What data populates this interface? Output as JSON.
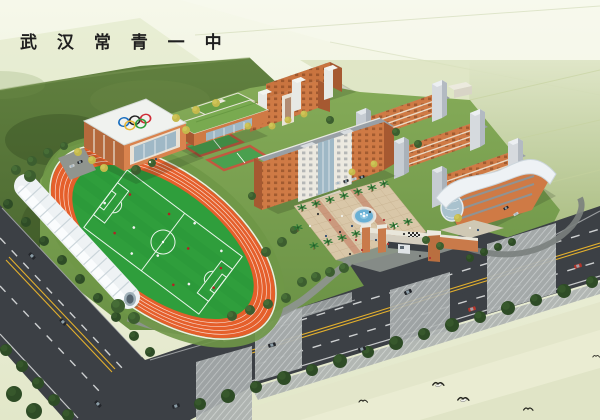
{
  "header": {
    "title": "武 汉 常 青 一 中"
  },
  "landmarks": [
    "gymnasium",
    "olympic-rings",
    "running-track",
    "soccer-field",
    "grandstand-canopy",
    "basketball-courts",
    "science-building",
    "dormitory-building",
    "main-classroom-building",
    "teaching-buildings",
    "library-curved-roof-building",
    "central-plaza",
    "fountain",
    "palm-trees",
    "entrance-gate",
    "gate-driveway",
    "main-road",
    "side-road",
    "intersection",
    "crosswalk-sidewalks",
    "roadside-trees",
    "cars",
    "pedestrians",
    "egrets"
  ],
  "colors": {
    "title_color": "#1f1f1f",
    "track": "#e55f2b",
    "pitch": "#2f9e3c",
    "road": "#3c4045",
    "road_yellow": "#e2af2d",
    "road_white": "#e8eaea",
    "sidewalk": "#a9aeae",
    "sidewalk_line": "#cfd3d3",
    "stand_white": "#eef2f4",
    "stand_rib": "#c7d2d8",
    "wall_orange": "#cf7a45",
    "wall_orange_dark": "#a65931",
    "wall_white": "#ece9e0",
    "tower_gray": "#c6ccd2",
    "roof_gray": "#99a0a6",
    "roof_green": "#79aa50",
    "glass": "#9fb8c6",
    "plaza": "#d9c7a8",
    "plaza_line": "#c3ad8b",
    "plaza_red": "#bd6c52",
    "water": "#69b0d4",
    "grass": "#7aa050",
    "forest": "#56743c",
    "tree_dark": "#2e4c26",
    "tree_mid": "#3c5e2f",
    "tree_yellow": "#c4b94c",
    "palm": "#2f7a36",
    "car_dark": "#23262b",
    "car_red": "#b5342a",
    "car_gray": "#c9ccce",
    "ring_blue": "#1a6fc0",
    "ring_black": "#222222",
    "ring_red": "#cf2b36",
    "ring_yellow": "#e8b93a",
    "ring_green": "#2f9e3c"
  },
  "scene": {
    "trees": [
      {
        "c": "mid",
        "items": [
          [
            16,
            170,
            5
          ],
          [
            32,
            161,
            5
          ],
          [
            48,
            153,
            5
          ],
          [
            64,
            146,
            4
          ]
        ]
      },
      {
        "c": "dark",
        "items": [
          [
            8,
            204,
            5
          ],
          [
            26,
            222,
            5
          ],
          [
            44,
            241,
            5
          ],
          [
            62,
            260,
            5
          ],
          [
            80,
            279,
            5
          ],
          [
            98,
            298,
            5
          ],
          [
            116,
            317,
            5
          ],
          [
            134,
            336,
            5
          ],
          [
            150,
            352,
            5
          ]
        ]
      },
      {
        "c": "dark",
        "items": [
          [
            6,
            350,
            6
          ],
          [
            22,
            366,
            6
          ],
          [
            38,
            383,
            6
          ],
          [
            54,
            400,
            6
          ],
          [
            14,
            394,
            8
          ],
          [
            34,
            411,
            8
          ],
          [
            68,
            415,
            6
          ]
        ]
      },
      {
        "c": "dark",
        "items": [
          [
            200,
            404,
            6
          ],
          [
            228,
            396,
            7
          ],
          [
            256,
            387,
            6
          ],
          [
            284,
            378,
            7
          ],
          [
            312,
            370,
            6
          ],
          [
            340,
            361,
            7
          ],
          [
            368,
            352,
            6
          ],
          [
            396,
            343,
            7
          ],
          [
            424,
            334,
            6
          ],
          [
            452,
            325,
            7
          ],
          [
            480,
            317,
            6
          ],
          [
            508,
            308,
            7
          ],
          [
            536,
            300,
            6
          ],
          [
            564,
            291,
            7
          ],
          [
            592,
            282,
            6
          ]
        ]
      },
      {
        "c": "mid",
        "items": [
          [
            232,
            316,
            5
          ],
          [
            250,
            310,
            5
          ],
          [
            268,
            304,
            5
          ],
          [
            286,
            298,
            5
          ],
          [
            302,
            282,
            5
          ],
          [
            316,
            277,
            5
          ],
          [
            330,
            272,
            5
          ],
          [
            344,
            268,
            5
          ]
        ]
      },
      {
        "c": "dark",
        "items": [
          [
            470,
            258,
            4
          ],
          [
            484,
            252,
            4
          ],
          [
            498,
            247,
            4
          ],
          [
            512,
            242,
            4
          ]
        ]
      },
      {
        "c": "mid",
        "items": [
          [
            136,
            170,
            5
          ],
          [
            152,
            163,
            4
          ],
          [
            252,
            196,
            4
          ],
          [
            266,
            252,
            5
          ],
          [
            282,
            242,
            5
          ],
          [
            294,
            230,
            4
          ],
          [
            426,
            240,
            4
          ],
          [
            440,
            246,
            4
          ],
          [
            330,
            120,
            4
          ],
          [
            396,
            132,
            4
          ],
          [
            418,
            144,
            4
          ],
          [
            30,
            176,
            6
          ],
          [
            118,
            306,
            7
          ],
          [
            134,
            318,
            6
          ]
        ]
      },
      {
        "c": "yellow",
        "items": [
          [
            78,
            152,
            4
          ],
          [
            92,
            160,
            4
          ],
          [
            104,
            168,
            4
          ],
          [
            186,
            130,
            4
          ],
          [
            176,
            118,
            4
          ],
          [
            196,
            110,
            4
          ],
          [
            216,
            103,
            4
          ],
          [
            272,
            126,
            3.5
          ],
          [
            288,
            120,
            3.5
          ],
          [
            304,
            114,
            3.5
          ],
          [
            458,
            218,
            4
          ],
          [
            248,
            126,
            3.5
          ],
          [
            352,
            172,
            3.5
          ],
          [
            374,
            164,
            3.5
          ]
        ]
      }
    ],
    "palms": [
      [
        302,
        212
      ],
      [
        316,
        208
      ],
      [
        330,
        204
      ],
      [
        344,
        200
      ],
      [
        358,
        196
      ],
      [
        372,
        192
      ],
      [
        384,
        188
      ],
      [
        314,
        250
      ],
      [
        328,
        246
      ],
      [
        342,
        242
      ],
      [
        356,
        238
      ],
      [
        394,
        230
      ],
      [
        408,
        226
      ],
      [
        298,
        232
      ]
    ],
    "people": [
      [
        318,
        214
      ],
      [
        330,
        220
      ],
      [
        342,
        216
      ],
      [
        352,
        226
      ],
      [
        370,
        212
      ],
      [
        384,
        220
      ],
      [
        396,
        226
      ],
      [
        326,
        236
      ],
      [
        340,
        232
      ],
      [
        356,
        240
      ],
      [
        310,
        226
      ],
      [
        376,
        240
      ],
      [
        404,
        234
      ],
      [
        388,
        244
      ],
      [
        150,
        162
      ],
      [
        156,
        159
      ],
      [
        420,
        256
      ],
      [
        430,
        258
      ],
      [
        470,
        228
      ],
      [
        478,
        230
      ],
      [
        350,
        254
      ],
      [
        362,
        250
      ]
    ],
    "players": [
      [
        -55,
        -18
      ],
      [
        -32,
        6
      ],
      [
        -12,
        -26
      ],
      [
        4,
        14
      ],
      [
        24,
        -10
      ],
      [
        46,
        18
      ],
      [
        62,
        -14
      ],
      [
        -70,
        4
      ],
      [
        34,
        28
      ],
      [
        -18,
        28
      ],
      [
        68,
        6
      ],
      [
        14,
        -34
      ],
      [
        -44,
        22
      ],
      [
        52,
        -28
      ]
    ],
    "cars": [
      {
        "x": 32,
        "y": 256,
        "a": 47,
        "c": "dark"
      },
      {
        "x": 63,
        "y": 322,
        "a": 47,
        "c": "dark"
      },
      {
        "x": 98,
        "y": 404,
        "a": 47,
        "c": "dark"
      },
      {
        "x": 176,
        "y": 406,
        "a": -17,
        "c": "dark"
      },
      {
        "x": 272,
        "y": 345,
        "a": -17,
        "c": "dark"
      },
      {
        "x": 362,
        "y": 349,
        "a": -17,
        "c": "dark"
      },
      {
        "x": 472,
        "y": 309,
        "a": -17,
        "c": "red"
      },
      {
        "x": 578,
        "y": 266,
        "a": -17,
        "c": "red"
      },
      {
        "x": 408,
        "y": 292,
        "a": -25,
        "c": "dark"
      },
      {
        "x": 338,
        "y": 183,
        "a": -17,
        "c": "gray",
        "s": 0.7
      },
      {
        "x": 346,
        "y": 181,
        "a": -17,
        "c": "dark",
        "s": 0.7
      },
      {
        "x": 354,
        "y": 179,
        "a": -17,
        "c": "gray",
        "s": 0.7
      },
      {
        "x": 362,
        "y": 177,
        "a": -17,
        "c": "dark",
        "s": 0.7
      },
      {
        "x": 72,
        "y": 166,
        "a": -20,
        "c": "gray",
        "s": 0.7
      },
      {
        "x": 80,
        "y": 162,
        "a": -20,
        "c": "dark",
        "s": 0.7
      },
      {
        "x": 506,
        "y": 208,
        "a": -30,
        "c": "dark",
        "s": 0.7
      },
      {
        "x": 516,
        "y": 214,
        "a": -30,
        "c": "gray",
        "s": 0.7
      }
    ],
    "birds": [
      {
        "x": 363,
        "y": 402,
        "s": 1.0,
        "t": "dark"
      },
      {
        "x": 438,
        "y": 385,
        "s": 1.3,
        "t": "white"
      },
      {
        "x": 463,
        "y": 400,
        "s": 1.3,
        "t": "white"
      },
      {
        "x": 528,
        "y": 410,
        "s": 1.1,
        "t": "dark"
      },
      {
        "x": 596,
        "y": 357,
        "s": 0.8,
        "t": "dark"
      }
    ]
  }
}
